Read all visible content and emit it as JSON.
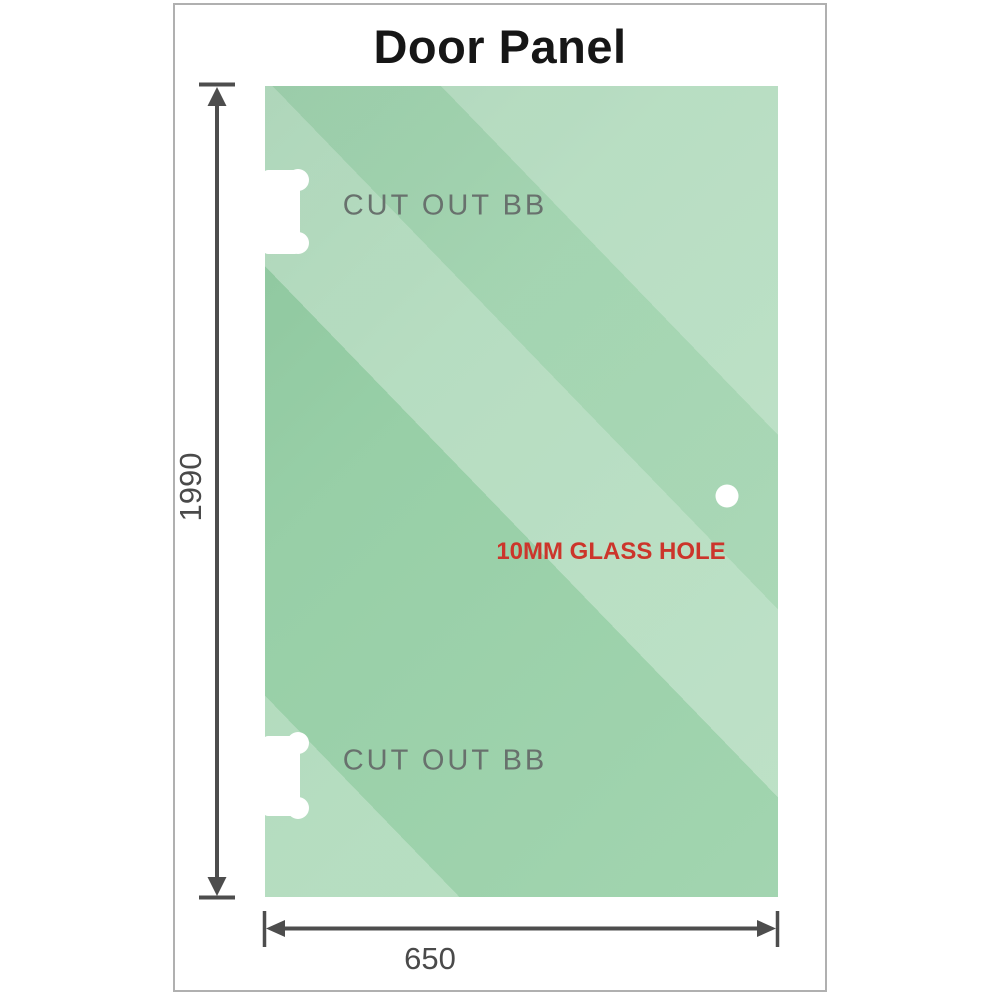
{
  "title": "Door Panel",
  "panel": {
    "top_cutout_label": "CUT OUT BB",
    "bottom_cutout_label": "CUT OUT BB",
    "hole_label": "10MM GLASS HOLE"
  },
  "dimensions": {
    "height": "1990",
    "width": "650"
  },
  "colors": {
    "glass_green": "#9ad1a9",
    "glass_highlight": "#c6e7d0",
    "dimension_gray": "#4d4d4d",
    "hole_label_red": "#cc352b",
    "cutout_label_gray": "#68716d",
    "title_black": "#161616",
    "frame_border_gray": "#b0b0b0"
  }
}
